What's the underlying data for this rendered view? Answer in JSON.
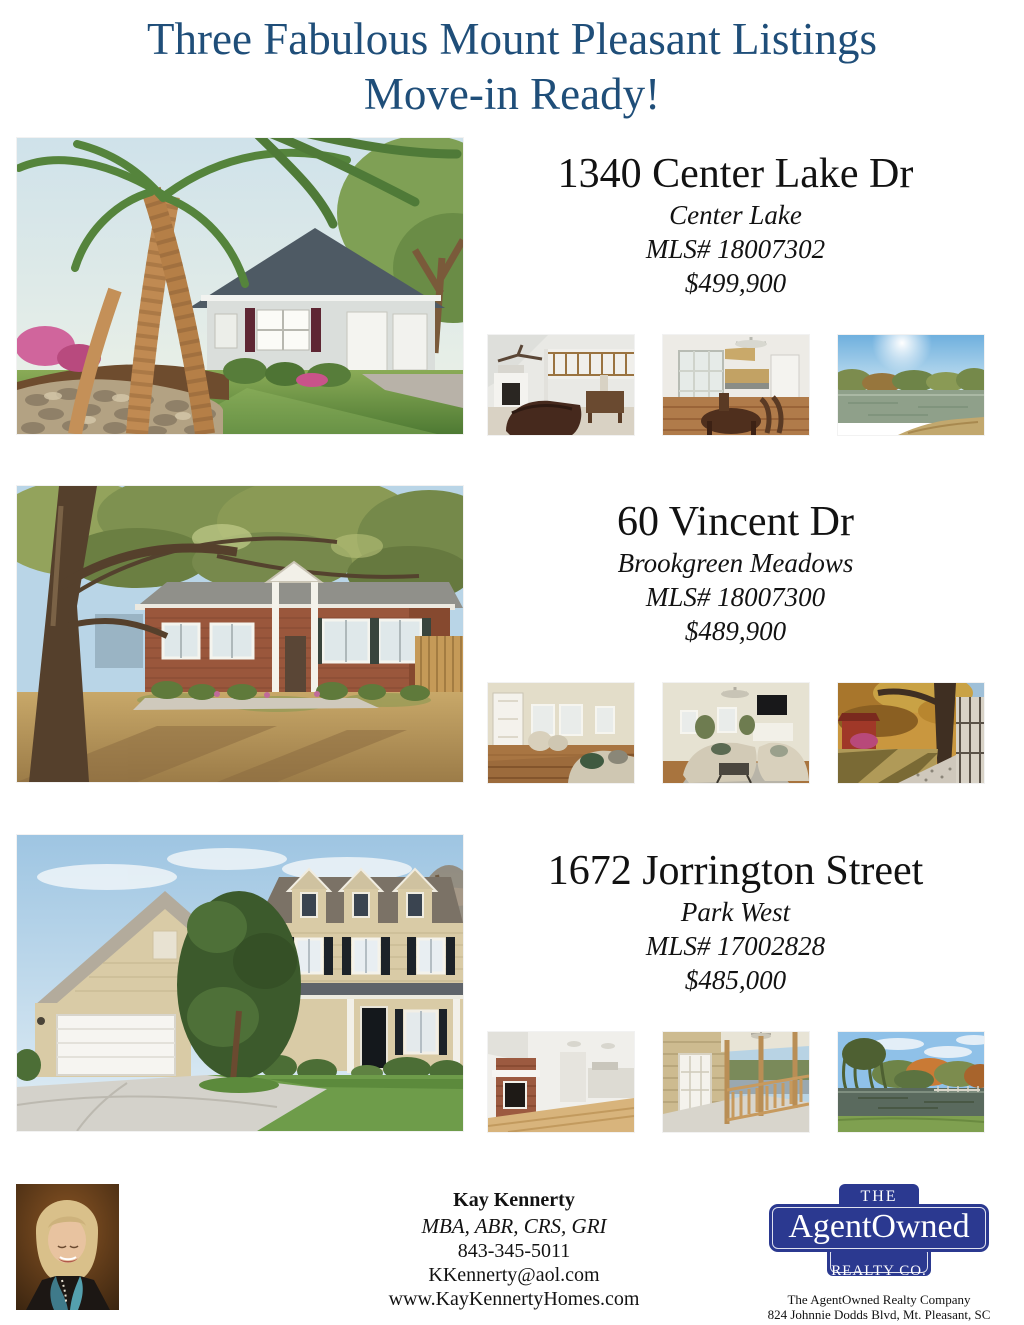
{
  "page": {
    "title_line1": "Three Fabulous Mount Pleasant Listings",
    "title_line2": "Move-in Ready!"
  },
  "listings": [
    {
      "address": "1340 Center Lake Dr",
      "neighborhood": "Center Lake",
      "mls": "MLS# 18007302",
      "price": "$499,900",
      "main_photo": "front exterior with palm trees and stone wall",
      "thumbs": [
        "living room with fireplace and loft",
        "kitchen and dining area",
        "lake view"
      ]
    },
    {
      "address": "60 Vincent Dr",
      "neighborhood": "Brookgreen Meadows",
      "mls": "MLS# 18007300",
      "price": "$489,900",
      "main_photo": "brick ranch under live oaks",
      "thumbs": [
        "entry and sitting room",
        "living room with TV",
        "backyard oak and porch"
      ]
    },
    {
      "address": "1672 Jorrington Street",
      "neighborhood": "Park West",
      "mls": "MLS# 17002828",
      "price": "$485,000",
      "main_photo": "two-story home with dormers and garage",
      "thumbs": [
        "fireplace and open living area",
        "screened porch",
        "pond with autumn trees"
      ]
    }
  ],
  "agent": {
    "name": "Kay Kennerty",
    "designations": "MBA, ABR, CRS, GRI",
    "phone": "843-345-5011",
    "email": "KKennerty@aol.com",
    "website": "www.KayKennertyHomes.com"
  },
  "brokerage": {
    "logo_the": "THE",
    "logo_name": "AgentOwned",
    "logo_realty": "REALTY CO.",
    "logo_tm": "TM",
    "company": "The AgentOwned Realty Company",
    "address": "824 Johnnie Dodds Blvd, Mt. Pleasant, SC 29464"
  },
  "colors": {
    "title_blue": "#1F4E79",
    "logo_blue": "#2B3990",
    "text_black": "#121212"
  }
}
